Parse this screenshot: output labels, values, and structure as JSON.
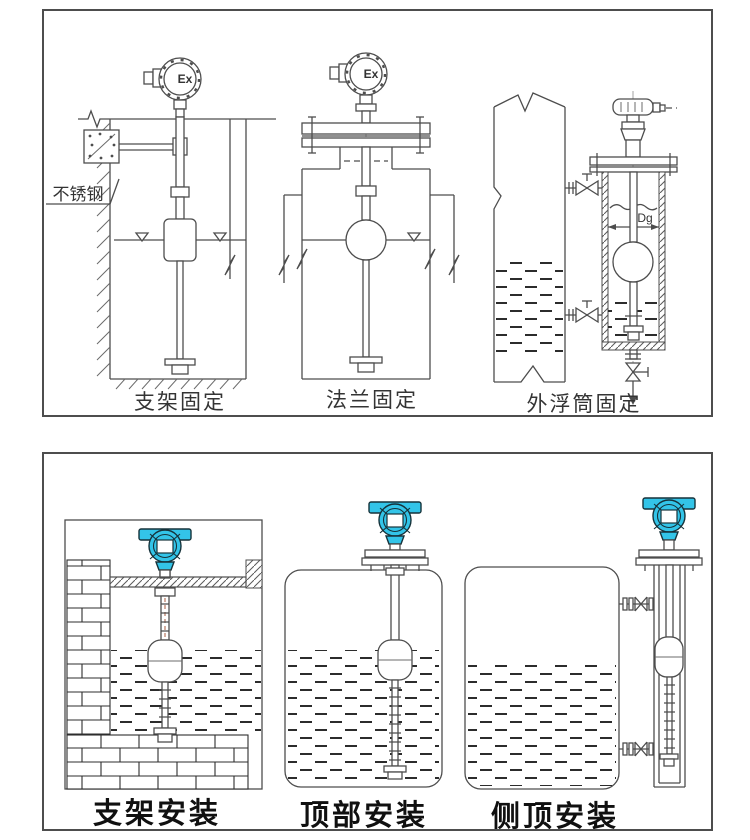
{
  "figure": {
    "top_panel": {
      "captions": [
        "支架固定",
        "法兰固定",
        "外浮筒固定"
      ],
      "annotations": {
        "stainless_steel": "不锈钢",
        "ex": "Ex",
        "diameter": "Dg"
      }
    },
    "bottom_panel": {
      "captions": [
        "支架安装",
        "顶部安装",
        "侧顶安装"
      ]
    }
  },
  "colors": {
    "transmitter": "#33c4e8",
    "line": "#4d4d4d",
    "ink": "#101010",
    "stem_centerline": "#b06a50"
  }
}
